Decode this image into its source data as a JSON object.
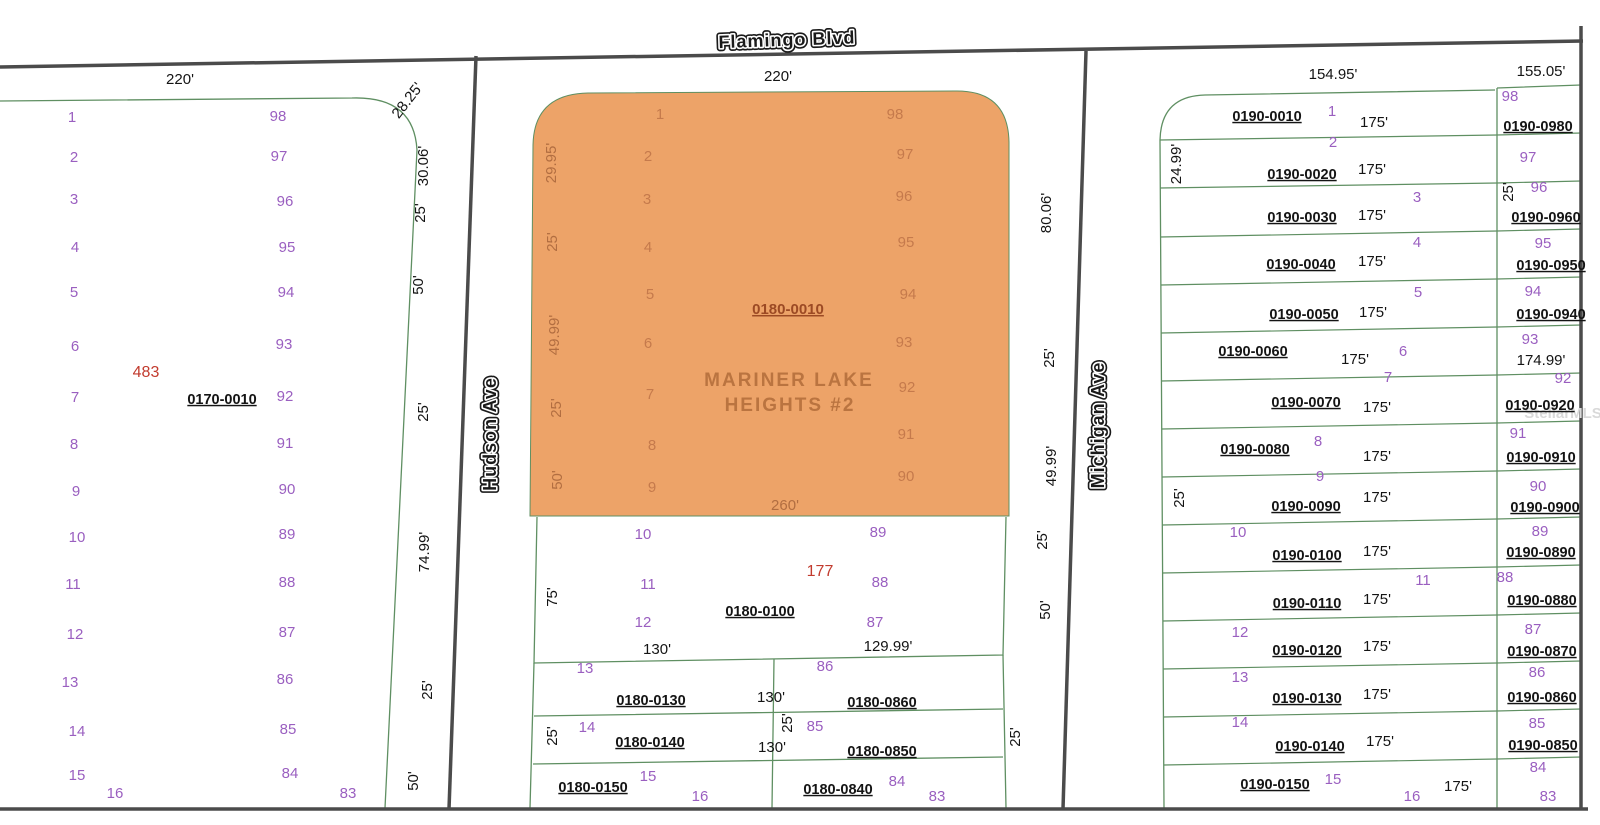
{
  "colors": {
    "background": "#ffffff",
    "orange_highlight": "#eda368",
    "parcel_line_green": "#5f8f62",
    "road_dark": "#4b4b4b",
    "lot_number_purple": "#9a5fc0",
    "parcel_id_black": "#141414",
    "highlight_number_red": "#c23b2e",
    "watermark_gray": "#d9d9d9"
  },
  "subdivision": {
    "name_line1": "MARINER LAKE",
    "name_line2": "HEIGHTS #2",
    "highlight_parcel_id": "0180-0010",
    "highlight_lot_count_label": "260'"
  },
  "streets": [
    {
      "name": "Flamingo Blvd",
      "x": 787,
      "y": 41,
      "rot": -2
    },
    {
      "name": "Hudson Ave",
      "x": 491,
      "y": 434,
      "rot": -90
    },
    {
      "name": "Michigan Ave",
      "x": 1099,
      "y": 425,
      "rot": -90
    }
  ],
  "watermark": {
    "text": "StellarMLS",
    "x": 1563,
    "y": 414
  },
  "map": {
    "orange_path": "M 530 516 L 533 145 Q 534 94 588 93 L 955 91 Q 1008 90 1009 142 L 1009 516 Z",
    "green_paths": [
      "M 0 101 L 352 98 Q 414 96 417 150 L 385 808",
      "M 537 517 L 534 663 L 1003 655 L 1006 517",
      "M 534 663 L 530 808 M 1003 655 L 1006 808 M 534 716 L 1003 709 M 533 764 L 1003 757 M 774 659 L 772 808",
      "M 1495 90 L 1205 95 Q 1161 96 1160 140 L 1164 808",
      "M 1497 88 L 1497 808 M 1497 88 L 1581 85"
    ],
    "green_lines": [
      [
        1160,
        140,
        1497,
        135
      ],
      [
        1160,
        188,
        1497,
        183
      ],
      [
        1160,
        237,
        1497,
        231
      ],
      [
        1161,
        285,
        1497,
        279
      ],
      [
        1161,
        333,
        1497,
        327
      ],
      [
        1161,
        381,
        1497,
        375
      ],
      [
        1162,
        429,
        1497,
        423
      ],
      [
        1162,
        477,
        1497,
        471
      ],
      [
        1162,
        525,
        1497,
        519
      ],
      [
        1162,
        573,
        1497,
        567
      ],
      [
        1163,
        621,
        1497,
        615
      ],
      [
        1163,
        669,
        1497,
        663
      ],
      [
        1163,
        717,
        1497,
        711
      ],
      [
        1164,
        765,
        1497,
        759
      ],
      [
        1497,
        135,
        1581,
        133
      ],
      [
        1497,
        183,
        1581,
        181
      ],
      [
        1497,
        231,
        1581,
        229
      ],
      [
        1497,
        279,
        1581,
        277
      ],
      [
        1497,
        327,
        1581,
        325
      ],
      [
        1497,
        375,
        1581,
        373
      ],
      [
        1497,
        423,
        1581,
        421
      ],
      [
        1497,
        471,
        1581,
        469
      ],
      [
        1497,
        519,
        1581,
        517
      ],
      [
        1497,
        567,
        1581,
        565
      ],
      [
        1497,
        615,
        1581,
        613
      ],
      [
        1497,
        663,
        1581,
        661
      ],
      [
        1497,
        711,
        1581,
        709
      ],
      [
        1497,
        759,
        1581,
        757
      ]
    ],
    "road_lines": [
      [
        0,
        67,
        1583,
        41
      ],
      [
        0,
        809,
        1588,
        809
      ],
      [
        476,
        56,
        449,
        809
      ],
      [
        1086,
        51,
        1063,
        809
      ],
      [
        1581,
        26,
        1581,
        809
      ]
    ],
    "labels": [
      [
        "220'",
        180,
        80,
        0,
        "dim",
        16
      ],
      [
        "1",
        72,
        118,
        0,
        "lot"
      ],
      [
        "98",
        278,
        117,
        0,
        "lot"
      ],
      [
        "2",
        74,
        158,
        0,
        "lot"
      ],
      [
        "97",
        279,
        157,
        0,
        "lot"
      ],
      [
        "3",
        74,
        200,
        0,
        "lot"
      ],
      [
        "96",
        285,
        202,
        0,
        "lot"
      ],
      [
        "4",
        75,
        248,
        0,
        "lot"
      ],
      [
        "95",
        287,
        248,
        0,
        "lot"
      ],
      [
        "5",
        74,
        293,
        0,
        "lot"
      ],
      [
        "94",
        286,
        293,
        0,
        "lot"
      ],
      [
        "6",
        75,
        347,
        0,
        "lot"
      ],
      [
        "93",
        284,
        345,
        0,
        "lot"
      ],
      [
        "7",
        75,
        398,
        0,
        "lot"
      ],
      [
        "92",
        285,
        397,
        0,
        "lot"
      ],
      [
        "8",
        74,
        445,
        0,
        "lot"
      ],
      [
        "91",
        285,
        444,
        0,
        "lot"
      ],
      [
        "9",
        76,
        492,
        0,
        "lot"
      ],
      [
        "90",
        287,
        490,
        0,
        "lot"
      ],
      [
        "10",
        77,
        538,
        0,
        "lot"
      ],
      [
        "89",
        287,
        535,
        0,
        "lot"
      ],
      [
        "11",
        73,
        585,
        0,
        "lot"
      ],
      [
        "88",
        287,
        583,
        0,
        "lot"
      ],
      [
        "12",
        75,
        635,
        0,
        "lot"
      ],
      [
        "87",
        287,
        633,
        0,
        "lot"
      ],
      [
        "13",
        70,
        683,
        0,
        "lot"
      ],
      [
        "86",
        285,
        680,
        0,
        "lot"
      ],
      [
        "14",
        77,
        732,
        0,
        "lot"
      ],
      [
        "85",
        288,
        730,
        0,
        "lot"
      ],
      [
        "15",
        77,
        776,
        0,
        "lot"
      ],
      [
        "84",
        290,
        774,
        0,
        "lot"
      ],
      [
        "16",
        115,
        794,
        0,
        "lot"
      ],
      [
        "83",
        348,
        794,
        0,
        "lot"
      ],
      [
        "483",
        146,
        373,
        0,
        "red"
      ],
      [
        "0170-0010",
        222,
        400,
        0,
        "pid"
      ],
      [
        "28.25'",
        408,
        101,
        -52,
        "dim"
      ],
      [
        "30.06'",
        424,
        166,
        -90,
        "dim"
      ],
      [
        "25'",
        421,
        213,
        -90,
        "dim"
      ],
      [
        "50'",
        419,
        285,
        -90,
        "dim"
      ],
      [
        "25'",
        424,
        412,
        -90,
        "dim"
      ],
      [
        "74.99'",
        425,
        552,
        -90,
        "dim"
      ],
      [
        "25'",
        428,
        690,
        -90,
        "dim"
      ],
      [
        "50'",
        414,
        781,
        -90,
        "dim"
      ],
      [
        "220'",
        778,
        77,
        0,
        "dim",
        16
      ],
      [
        "1",
        660,
        115,
        0,
        "olot"
      ],
      [
        "98",
        895,
        115,
        0,
        "olot"
      ],
      [
        "2",
        648,
        157,
        0,
        "olot"
      ],
      [
        "97",
        905,
        155,
        0,
        "olot"
      ],
      [
        "3",
        647,
        200,
        0,
        "olot"
      ],
      [
        "96",
        904,
        197,
        0,
        "olot"
      ],
      [
        "4",
        648,
        248,
        0,
        "olot"
      ],
      [
        "95",
        906,
        243,
        0,
        "olot"
      ],
      [
        "5",
        650,
        295,
        0,
        "olot"
      ],
      [
        "94",
        908,
        295,
        0,
        "olot"
      ],
      [
        "6",
        648,
        344,
        0,
        "olot"
      ],
      [
        "93",
        904,
        343,
        0,
        "olot"
      ],
      [
        "7",
        650,
        395,
        0,
        "olot"
      ],
      [
        "92",
        907,
        388,
        0,
        "olot"
      ],
      [
        "8",
        652,
        446,
        0,
        "olot"
      ],
      [
        "91",
        906,
        435,
        0,
        "olot"
      ],
      [
        "9",
        652,
        488,
        0,
        "olot"
      ],
      [
        "90",
        906,
        477,
        0,
        "olot"
      ],
      [
        "29.95'",
        552,
        163,
        -90,
        "odim"
      ],
      [
        "25'",
        553,
        242,
        -90,
        "odim"
      ],
      [
        "49.99'",
        555,
        335,
        -90,
        "odim"
      ],
      [
        "25'",
        557,
        408,
        -90,
        "odim"
      ],
      [
        "50'",
        558,
        480,
        -90,
        "odim"
      ],
      [
        "0180-0010",
        788,
        310,
        0,
        "opid"
      ],
      [
        "260'",
        785,
        506,
        0,
        "odim",
        16
      ],
      [
        "80.06'",
        1047,
        213,
        -90,
        "dim"
      ],
      [
        "25'",
        1050,
        358,
        -90,
        "dim"
      ],
      [
        "49.99'",
        1052,
        466,
        -90,
        "dim"
      ],
      [
        "25'",
        1043,
        540,
        -90,
        "dim"
      ],
      [
        "50'",
        1046,
        610,
        -90,
        "dim"
      ],
      [
        "25'",
        1016,
        737,
        -90,
        "dim"
      ],
      [
        "10",
        643,
        535,
        0,
        "lot"
      ],
      [
        "89",
        878,
        533,
        0,
        "lot"
      ],
      [
        "11",
        648,
        585,
        0,
        "lot"
      ],
      [
        "88",
        880,
        583,
        0,
        "lot"
      ],
      [
        "12",
        643,
        623,
        0,
        "lot"
      ],
      [
        "87",
        875,
        623,
        0,
        "lot"
      ],
      [
        "177",
        820,
        572,
        0,
        "red"
      ],
      [
        "0180-0100",
        760,
        612,
        0,
        "pid"
      ],
      [
        "75'",
        553,
        597,
        -90,
        "dim"
      ],
      [
        "130'",
        657,
        650,
        0,
        "dim",
        16
      ],
      [
        "129.99'",
        888,
        647,
        0,
        "dim",
        16
      ],
      [
        "13",
        585,
        669,
        0,
        "lot"
      ],
      [
        "86",
        825,
        667,
        0,
        "lot"
      ],
      [
        "0180-0130",
        651,
        701,
        0,
        "pid"
      ],
      [
        "130'",
        771,
        698,
        0,
        "dim",
        16
      ],
      [
        "0180-0860",
        882,
        703,
        0,
        "pid"
      ],
      [
        "25'",
        788,
        723,
        -90,
        "dim"
      ],
      [
        "25'",
        553,
        736,
        -90,
        "dim"
      ],
      [
        "14",
        587,
        728,
        0,
        "lot"
      ],
      [
        "0180-0140",
        650,
        743,
        0,
        "pid"
      ],
      [
        "130'",
        772,
        748,
        0,
        "dim",
        16
      ],
      [
        "85",
        815,
        727,
        0,
        "lot"
      ],
      [
        "0180-0850",
        882,
        752,
        0,
        "pid"
      ],
      [
        "0180-0150",
        593,
        788,
        0,
        "pid"
      ],
      [
        "15",
        648,
        777,
        0,
        "lot"
      ],
      [
        "16",
        700,
        797,
        0,
        "lot"
      ],
      [
        "0180-0840",
        838,
        790,
        0,
        "pid"
      ],
      [
        "84",
        897,
        782,
        0,
        "lot"
      ],
      [
        "83",
        937,
        797,
        0,
        "lot"
      ],
      [
        "154.95'",
        1333,
        75,
        0,
        "dim",
        16
      ],
      [
        "155.05'",
        1541,
        72,
        0,
        "dim",
        16
      ],
      [
        "24.99'",
        1177,
        164,
        -90,
        "dim"
      ],
      [
        "25'",
        1180,
        498,
        -90,
        "dim"
      ],
      [
        "0190-0010",
        1267,
        117,
        0,
        "pid"
      ],
      [
        "1",
        1332,
        112,
        0,
        "lot"
      ],
      [
        "175'",
        1374,
        123,
        0,
        "dim",
        17
      ],
      [
        "2",
        1333,
        143,
        0,
        "lot"
      ],
      [
        "0190-0020",
        1302,
        175,
        0,
        "pid"
      ],
      [
        "175'",
        1372,
        170,
        0,
        "dim",
        17
      ],
      [
        "3",
        1417,
        198,
        0,
        "lot"
      ],
      [
        "0190-0030",
        1302,
        218,
        0,
        "pid"
      ],
      [
        "175'",
        1372,
        216,
        0,
        "dim",
        17
      ],
      [
        "4",
        1417,
        243,
        0,
        "lot"
      ],
      [
        "0190-0040",
        1301,
        265,
        0,
        "pid"
      ],
      [
        "175'",
        1372,
        262,
        0,
        "dim",
        17
      ],
      [
        "5",
        1418,
        293,
        0,
        "lot"
      ],
      [
        "0190-0050",
        1304,
        315,
        0,
        "pid"
      ],
      [
        "175'",
        1373,
        313,
        0,
        "dim",
        17
      ],
      [
        "0190-0060",
        1253,
        352,
        0,
        "pid"
      ],
      [
        "175'",
        1355,
        360,
        0,
        "dim",
        17
      ],
      [
        "6",
        1403,
        352,
        0,
        "lot"
      ],
      [
        "7",
        1388,
        378,
        0,
        "lot"
      ],
      [
        "0190-0070",
        1306,
        403,
        0,
        "pid"
      ],
      [
        "175'",
        1377,
        408,
        0,
        "dim",
        17
      ],
      [
        "0190-0080",
        1255,
        450,
        0,
        "pid"
      ],
      [
        "8",
        1318,
        442,
        0,
        "lot"
      ],
      [
        "175'",
        1377,
        457,
        0,
        "dim",
        17
      ],
      [
        "9",
        1320,
        477,
        0,
        "lot"
      ],
      [
        "0190-0090",
        1306,
        507,
        0,
        "pid"
      ],
      [
        "175'",
        1377,
        498,
        0,
        "dim",
        17
      ],
      [
        "10",
        1238,
        533,
        0,
        "lot"
      ],
      [
        "0190-0100",
        1307,
        556,
        0,
        "pid"
      ],
      [
        "175'",
        1377,
        552,
        0,
        "dim",
        17
      ],
      [
        "11",
        1423,
        581,
        0,
        "lot"
      ],
      [
        "0190-0110",
        1307,
        604,
        0,
        "pid"
      ],
      [
        "175'",
        1377,
        600,
        0,
        "dim",
        17
      ],
      [
        "12",
        1240,
        633,
        0,
        "lot"
      ],
      [
        "0190-0120",
        1307,
        651,
        0,
        "pid"
      ],
      [
        "175'",
        1377,
        647,
        0,
        "dim",
        17
      ],
      [
        "13",
        1240,
        678,
        0,
        "lot"
      ],
      [
        "0190-0130",
        1307,
        699,
        0,
        "pid"
      ],
      [
        "175'",
        1377,
        695,
        0,
        "dim",
        17
      ],
      [
        "14",
        1240,
        723,
        0,
        "lot"
      ],
      [
        "0190-0140",
        1310,
        747,
        0,
        "pid"
      ],
      [
        "175'",
        1380,
        742,
        0,
        "dim",
        17
      ],
      [
        "0190-0150",
        1275,
        785,
        0,
        "pid"
      ],
      [
        "15",
        1333,
        780,
        0,
        "lot"
      ],
      [
        "16",
        1412,
        797,
        0,
        "lot"
      ],
      [
        "175'",
        1458,
        787,
        0,
        "dim",
        17
      ],
      [
        "98",
        1510,
        97,
        0,
        "lot"
      ],
      [
        "0190-0980",
        1538,
        127,
        0,
        "pid"
      ],
      [
        "97",
        1528,
        158,
        0,
        "lot"
      ],
      [
        "25'",
        1509,
        192,
        -90,
        "dim"
      ],
      [
        "96",
        1539,
        188,
        0,
        "lot"
      ],
      [
        "0190-0960",
        1546,
        218,
        0,
        "pid"
      ],
      [
        "95",
        1543,
        244,
        0,
        "lot"
      ],
      [
        "0190-0950",
        1551,
        266,
        0,
        "pid"
      ],
      [
        "94",
        1533,
        292,
        0,
        "lot"
      ],
      [
        "0190-0940",
        1551,
        315,
        0,
        "pid"
      ],
      [
        "93",
        1530,
        340,
        0,
        "lot"
      ],
      [
        "174.99'",
        1541,
        361,
        0,
        "dim",
        16
      ],
      [
        "92",
        1563,
        379,
        0,
        "lot"
      ],
      [
        "0190-0920",
        1540,
        406,
        0,
        "pid"
      ],
      [
        "91",
        1518,
        434,
        0,
        "lot"
      ],
      [
        "0190-0910",
        1541,
        458,
        0,
        "pid"
      ],
      [
        "90",
        1538,
        487,
        0,
        "lot"
      ],
      [
        "0190-0900",
        1545,
        508,
        0,
        "pid"
      ],
      [
        "89",
        1540,
        532,
        0,
        "lot"
      ],
      [
        "0190-0890",
        1541,
        553,
        0,
        "pid"
      ],
      [
        "88",
        1505,
        578,
        0,
        "lot"
      ],
      [
        "0190-0880",
        1542,
        601,
        0,
        "pid"
      ],
      [
        "87",
        1533,
        630,
        0,
        "lot"
      ],
      [
        "0190-0870",
        1542,
        652,
        0,
        "pid"
      ],
      [
        "86",
        1537,
        673,
        0,
        "lot"
      ],
      [
        "0190-0860",
        1542,
        698,
        0,
        "pid"
      ],
      [
        "85",
        1537,
        724,
        0,
        "lot"
      ],
      [
        "0190-0850",
        1543,
        746,
        0,
        "pid"
      ],
      [
        "84",
        1538,
        768,
        0,
        "lot"
      ],
      [
        "83",
        1548,
        797,
        0,
        "lot"
      ]
    ],
    "subdivision_name_pos": {
      "line1_x": 789,
      "line1_y": 381,
      "line2_x": 790,
      "line2_y": 406
    }
  }
}
